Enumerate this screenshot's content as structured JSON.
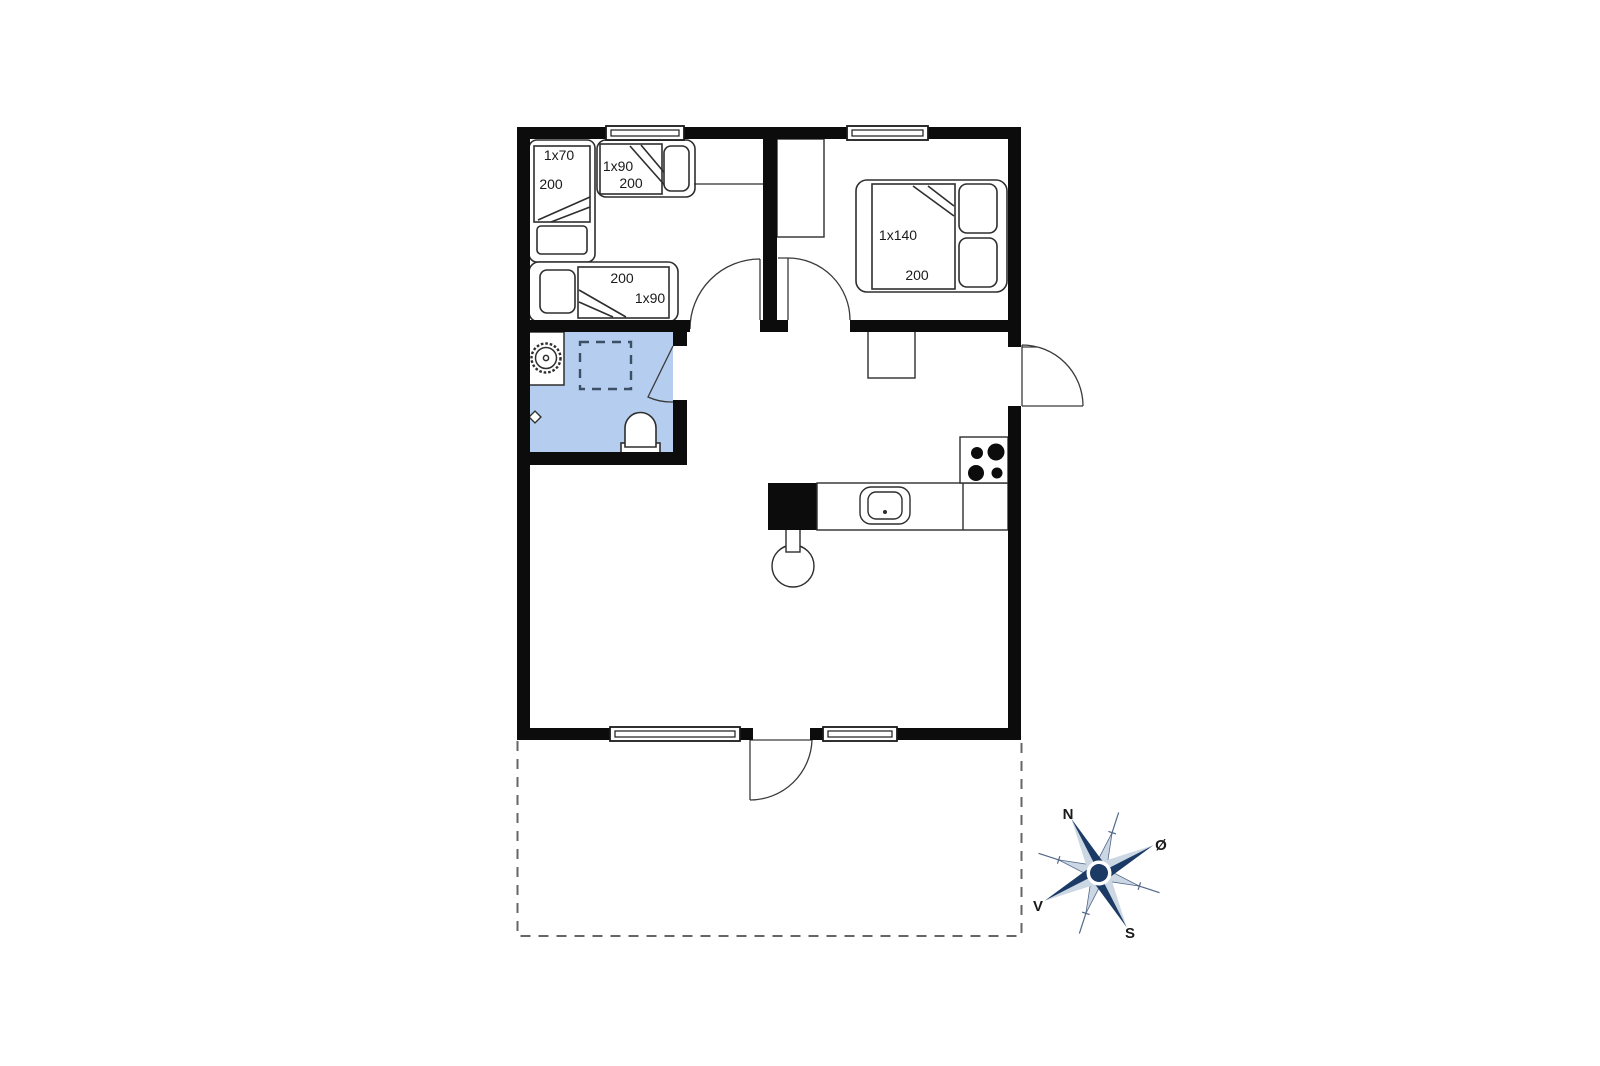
{
  "plan": {
    "bedroom1": {
      "bed_a": {
        "width": "1x70",
        "length": "200"
      },
      "bed_b": {
        "width": "1x90",
        "length": "200"
      },
      "bed_c": {
        "length": "200",
        "width": "1x90"
      }
    },
    "bedroom2": {
      "double_bed": {
        "width": "1x140",
        "length": "200"
      }
    },
    "compass": {
      "north": "N",
      "east": "Ø",
      "south": "S",
      "west": "V"
    },
    "colors": {
      "wall": "#0c0c0c",
      "bathroom_fill": "#b5cdee",
      "line": "#2e2e2e",
      "compass_dark": "#1c3a66",
      "compass_light": "#ccd7e4",
      "terrace_dash": "#666666"
    }
  }
}
